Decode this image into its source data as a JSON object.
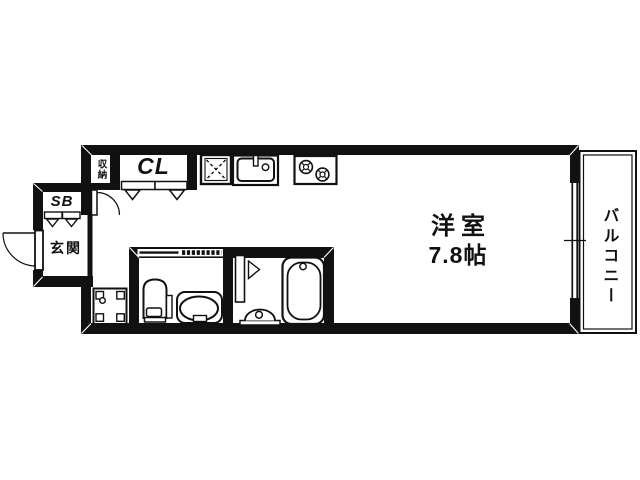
{
  "plan": {
    "rooms": {
      "storage": {
        "label": "収納"
      },
      "closet": {
        "label": "CL"
      },
      "shoe_box": {
        "label": "SB"
      },
      "entrance": {
        "label": "玄関"
      },
      "main_room": {
        "label": "洋室",
        "size": "7.8帖"
      },
      "balcony": {
        "label": "バルコニー"
      }
    },
    "fixtures": [
      "refrigerator-space",
      "kitchen-sink",
      "gas-stove",
      "washing-machine-space",
      "toilet",
      "washbasin",
      "folding-door",
      "bathtub",
      "bath-counter",
      "entrance-door",
      "sliding-window"
    ],
    "colors": {
      "wall": "#111111",
      "background": "#ffffff"
    }
  }
}
